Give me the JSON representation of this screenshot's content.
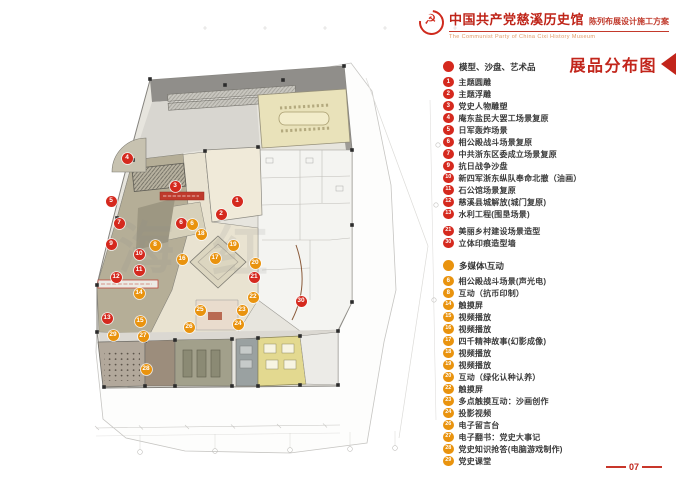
{
  "header": {
    "logo_icon": "party-emblem",
    "title": "中国共产党慈溪历史馆",
    "subtitle": "陈列布展设计施工方案",
    "subtitle_en": "The Communist Party of China Cixi  History Museum"
  },
  "panel": {
    "title": "展品分布图",
    "page_number": "07",
    "sections": [
      {
        "id": "models",
        "color": "#d5291e",
        "label": "模型、沙盘、艺术品",
        "items": [
          {
            "num": "1",
            "label": "主题圆雕"
          },
          {
            "num": "2",
            "label": "主题浮雕"
          },
          {
            "num": "3",
            "label": "党史人物雕塑"
          },
          {
            "num": "4",
            "label": "庵东盐民大罢工场景复原"
          },
          {
            "num": "5",
            "label": "日军轰炸场景"
          },
          {
            "num": "6",
            "label": "相公殿战斗场景复原"
          },
          {
            "num": "7",
            "label": "中共浙东区委成立场景复原"
          },
          {
            "num": "9",
            "label": "抗日战争沙盘"
          },
          {
            "num": "10",
            "label": "新四军浙东纵队奉命北撤（油画）"
          },
          {
            "num": "11",
            "label": "石公馆场景复原"
          },
          {
            "num": "12",
            "label": "慈溪县城解放(城门复原)"
          },
          {
            "num": "13",
            "label": "水利工程(围垦场景)"
          },
          {
            "num": "21",
            "label": "美丽乡村建设场景造型",
            "gap": true
          },
          {
            "num": "30",
            "label": "立体印痕造型墙"
          }
        ]
      },
      {
        "id": "multimedia",
        "color": "#e9930e",
        "label": "多媒体\\互动",
        "items": [
          {
            "num": "6",
            "label": "相公殿战斗场景(声光电)"
          },
          {
            "num": "8",
            "label": "互动（抗币印制）"
          },
          {
            "num": "14",
            "label": "触摸屏"
          },
          {
            "num": "15",
            "label": "视频播放"
          },
          {
            "num": "16",
            "label": "视频播放"
          },
          {
            "num": "17",
            "label": "四千精神故事(幻影成像)"
          },
          {
            "num": "18",
            "label": "视频播放"
          },
          {
            "num": "19",
            "label": "视频播放"
          },
          {
            "num": "20",
            "label": "互动（绿化认种认养）"
          },
          {
            "num": "22",
            "label": "触摸屏"
          },
          {
            "num": "23",
            "label": "多点触摸互动：沙画创作"
          },
          {
            "num": "24",
            "label": "投影视频"
          },
          {
            "num": "26",
            "label": "电子留言台"
          },
          {
            "num": "27",
            "label": "电子翻书：党史大事记"
          },
          {
            "num": "28",
            "label": "党史知识抢答(电脑游戏制作)"
          },
          {
            "num": "29",
            "label": "党史课堂"
          }
        ]
      }
    ]
  },
  "plan": {
    "watermark": [
      "海",
      "红"
    ],
    "markers": [
      {
        "num": "1",
        "type": "red",
        "x": 237,
        "y": 201
      },
      {
        "num": "2",
        "type": "red",
        "x": 221,
        "y": 214
      },
      {
        "num": "3",
        "type": "red",
        "x": 175,
        "y": 186
      },
      {
        "num": "4",
        "type": "red",
        "x": 127,
        "y": 158
      },
      {
        "num": "5",
        "type": "red",
        "x": 111,
        "y": 201
      },
      {
        "num": "6",
        "type": "red",
        "x": 181,
        "y": 223
      },
      {
        "num": "7",
        "type": "red",
        "x": 119,
        "y": 223
      },
      {
        "num": "9",
        "type": "red",
        "x": 111,
        "y": 244
      },
      {
        "num": "10",
        "type": "red",
        "x": 139,
        "y": 254
      },
      {
        "num": "11",
        "type": "red",
        "x": 139,
        "y": 270
      },
      {
        "num": "12",
        "type": "red",
        "x": 116,
        "y": 277
      },
      {
        "num": "13",
        "type": "red",
        "x": 107,
        "y": 318
      },
      {
        "num": "21",
        "type": "red",
        "x": 254,
        "y": 277
      },
      {
        "num": "30",
        "type": "red",
        "x": 301,
        "y": 301
      },
      {
        "num": "6",
        "type": "orange",
        "x": 192,
        "y": 224
      },
      {
        "num": "8",
        "type": "orange",
        "x": 155,
        "y": 245
      },
      {
        "num": "14",
        "type": "orange",
        "x": 139,
        "y": 293
      },
      {
        "num": "15",
        "type": "orange",
        "x": 140,
        "y": 321
      },
      {
        "num": "16",
        "type": "orange",
        "x": 182,
        "y": 259
      },
      {
        "num": "17",
        "type": "orange",
        "x": 215,
        "y": 258
      },
      {
        "num": "18",
        "type": "orange",
        "x": 201,
        "y": 234
      },
      {
        "num": "19",
        "type": "orange",
        "x": 233,
        "y": 245
      },
      {
        "num": "20",
        "type": "orange",
        "x": 255,
        "y": 263
      },
      {
        "num": "22",
        "type": "orange",
        "x": 253,
        "y": 297
      },
      {
        "num": "23",
        "type": "orange",
        "x": 242,
        "y": 310
      },
      {
        "num": "24",
        "type": "orange",
        "x": 238,
        "y": 324
      },
      {
        "num": "25",
        "type": "orange",
        "x": 200,
        "y": 310
      },
      {
        "num": "26",
        "type": "orange",
        "x": 189,
        "y": 327
      },
      {
        "num": "27",
        "type": "orange",
        "x": 143,
        "y": 336
      },
      {
        "num": "28",
        "type": "orange",
        "x": 146,
        "y": 369
      },
      {
        "num": "29",
        "type": "orange",
        "x": 113,
        "y": 335
      }
    ]
  }
}
